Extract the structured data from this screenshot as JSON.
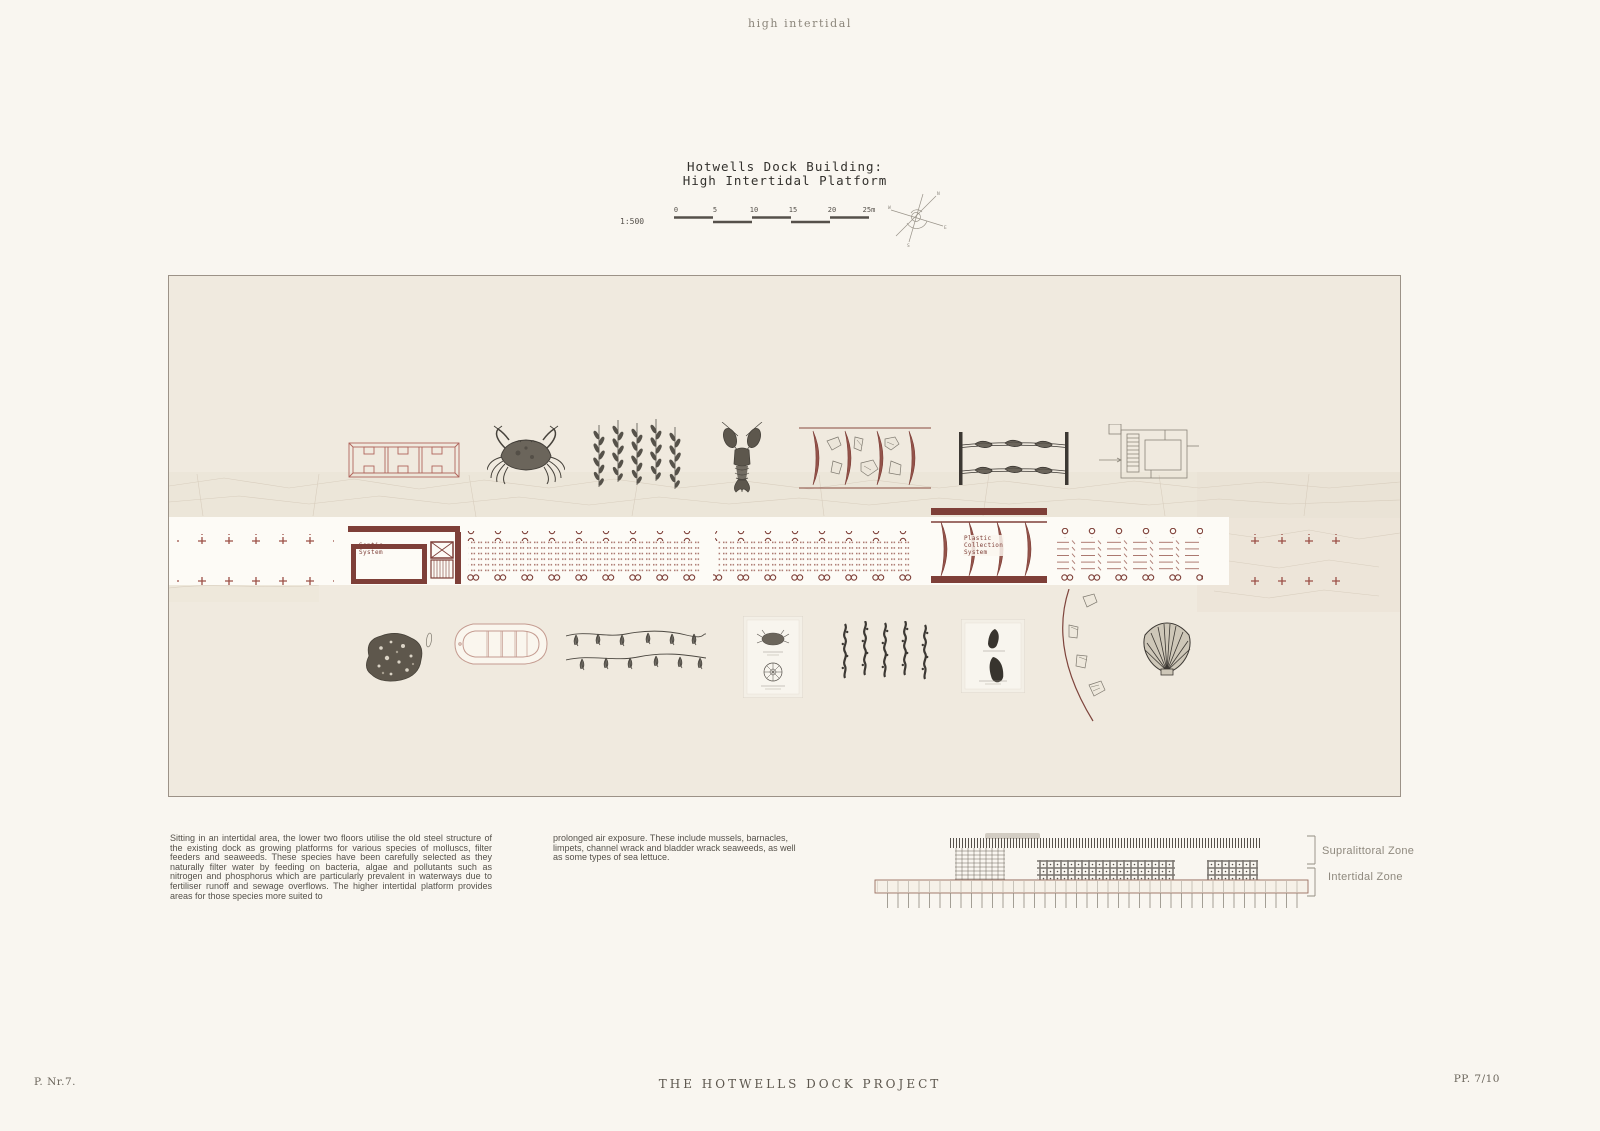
{
  "page": {
    "top_label": "high intertidal",
    "footer_left": "P. Nr.7.",
    "footer_center": "THE HOTWELLS DOCK PROJECT",
    "footer_right": "PP. 7/10"
  },
  "title_block": {
    "line1": "Hotwells Dock Building:",
    "line2": "High Intertidal Platform",
    "scale_label": "1:500",
    "scale_ticks": [
      "0",
      "5",
      "10",
      "15",
      "20",
      "25m"
    ]
  },
  "compass": {
    "n": "N",
    "e": "E",
    "s": "S",
    "w": "W"
  },
  "plan": {
    "septic_label_line1": "Septic",
    "septic_label_line2": "System",
    "plastic_label_line1": "Plastic",
    "plastic_label_line2": "Collection",
    "plastic_label_line3": "System",
    "illustrations": [
      "growing-crate",
      "shore-crab",
      "hanging-seaweed",
      "lobster",
      "plastic-debris-screen",
      "mussel-ropes",
      "platform-floorplan",
      "barnacle-rock",
      "inflatable-boat",
      "seaweed-garland",
      "specimen-plate-crab-urchin",
      "kelp-strands",
      "specimen-plate-mussels",
      "debris-boom",
      "scallop-shell"
    ]
  },
  "body_text": {
    "column1": "Sitting in an intertidal area, the lower two floors utilise the old steel structure of the existing dock as growing platforms for various species of molluscs, filter feeders and seaweeds. These species have been carefully selected as they naturally filter water by feeding on bacteria, algae and pollutants such as nitrogen and phosphorus which are particularly prevalent in waterways due to fertiliser runoff and sewage overflows. The higher intertidal platform provides areas for those species more suited to",
    "column2": "prolonged air exposure. These include mussels, barnacles, limpets, channel wrack and bladder wrack seaweeds, as well as some types of sea lettuce."
  },
  "section": {
    "zone_label_1": "Supralittoral Zone",
    "zone_label_2": "Intertidal Zone"
  },
  "colors": {
    "maroon": "#7e3f38",
    "cross_red": "#9c4f46",
    "dot_red": "#a8746b",
    "panel_bg": "#f0eadf",
    "page_bg": "#f9f6f0",
    "ink": "#4a463f"
  }
}
